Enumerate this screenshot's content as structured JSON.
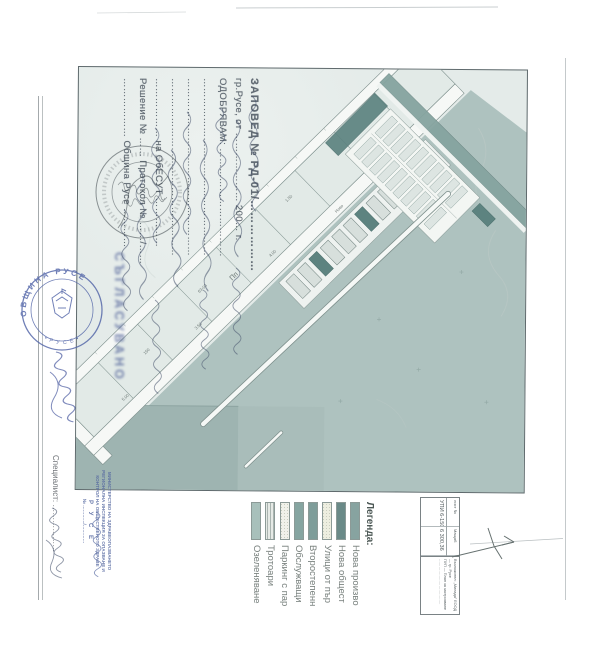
{
  "order_block": {
    "title": "ЗАПОВЕД № РД-01/………………",
    "line_city": "гр.Русе, от ………………… 200… г.",
    "line_approve": "ОДОБРЯВАМ: ……………………………",
    "dots1": "………………………………………………",
    "dots2": "………………………………………………",
    "dots3": "………………………………………………",
    "line_obesut": "……………… на ОбЕСУТ ……………",
    "line_resh": "Решение № …… Протокол № ……/……",
    "line_obshtina": "……………… Община Русе …………"
  },
  "approved_smudge": "СЪГЛАСУВАНО",
  "stamps": {
    "municipal_ring_top": "ОБЩИНА РУСЕ",
    "municipal_ring_bottom": "• Р У С Е •",
    "ministry_lines": [
      "МИНИСТЕРСТВО НА ЗДРАВЕОПАЗВАНЕТО",
      "РЕГИОНАЛНА ИНСПЕКЦИЯ ЗА ОПАЗВАНЕ И",
      "КОНТРОЛ НА ОБЩЕСТВЕНОТО ЗДРАВЕ",
      "Р У С Е",
      "№ …………/…………"
    ]
  },
  "specialist_label": "Специалист: ………………",
  "legend": {
    "title": "Легенда:",
    "items": [
      {
        "label": "Нова произво",
        "color": "#87a3a0",
        "pattern": "solid"
      },
      {
        "label": "Нова общест",
        "color": "#6a8a88",
        "pattern": "solid"
      },
      {
        "label": "Улици от пър",
        "color": "#edeee0",
        "pattern": "speckle"
      },
      {
        "label": "Второстепенн",
        "color": "#7e9d9a",
        "pattern": "solid"
      },
      {
        "label": "Обслужващи",
        "color": "#86a5a1",
        "pattern": "solid"
      },
      {
        "label": "Паркинг с пар",
        "color": "#f0f1ea",
        "pattern": "speckle"
      },
      {
        "label": "Тротоари",
        "color": "#e6eae6",
        "pattern": "hatch"
      },
      {
        "label": "Озеленяване",
        "color": "#a8c0bb",
        "pattern": "solid"
      }
    ]
  },
  "title_block": {
    "sheet_label": "лист №",
    "scale_label": "Мащаб",
    "cell_upi": "УПИ 6-150",
    "cell_area": "6 300,36",
    "client_line1": "Възложител: „Милада” ЕООД — гр. Русе",
    "client_line2": "ПУП — План за застрояване",
    "client_line3": "………………………………"
  },
  "map": {
    "labels": [
      {
        "t": "Пп"
      },
      {
        "t": "63-03"
      },
      {
        "t": "3.50"
      },
      {
        "t": "4.00"
      },
      {
        "t": "1.50"
      },
      {
        "t": "150"
      },
      {
        "t": "5.00"
      },
      {
        "t": "Ново"
      }
    ]
  },
  "colors": {
    "sheet_wash": "#e4ebe9",
    "water": "#aec2bf",
    "water_dark": "#9eb4b1",
    "road_white": "#f6f8f6",
    "building_teal": "#5d8380",
    "street_teal": "#85a4a0",
    "stamp_blue": "#5265a8",
    "ink_black": "#3c464b"
  }
}
